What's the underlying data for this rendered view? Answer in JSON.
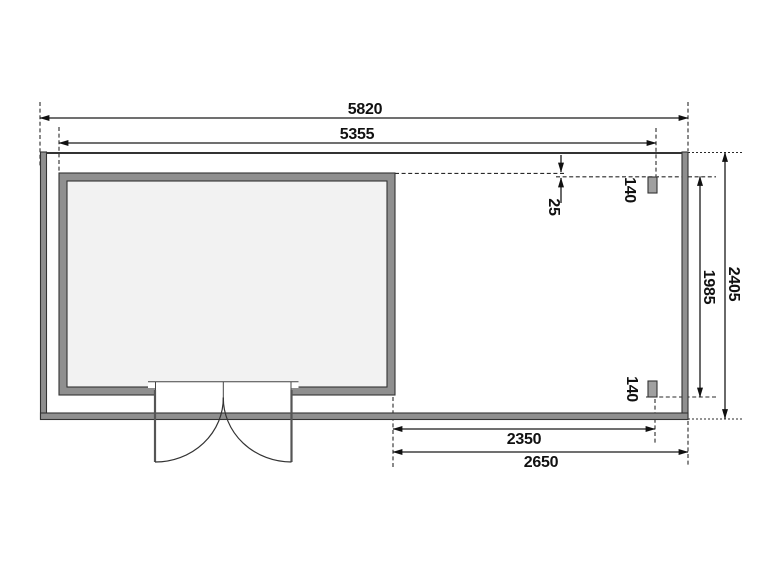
{
  "drawing": {
    "type": "floor-plan",
    "colors": {
      "background": "#ffffff",
      "line_color": "#1a1a1a",
      "wall_fill": "#8f8f8f",
      "interior_fill": "#f2f2f2",
      "post_fill": "#a0a0a0"
    },
    "dims": {
      "top_outer": "5820",
      "top_inner": "5355",
      "offset_25": "25",
      "post_top": "140",
      "post_bottom": "140",
      "right_inner": "1985",
      "right_outer": "2405",
      "bottom_inner": "2350",
      "bottom_outer": "2650"
    }
  }
}
